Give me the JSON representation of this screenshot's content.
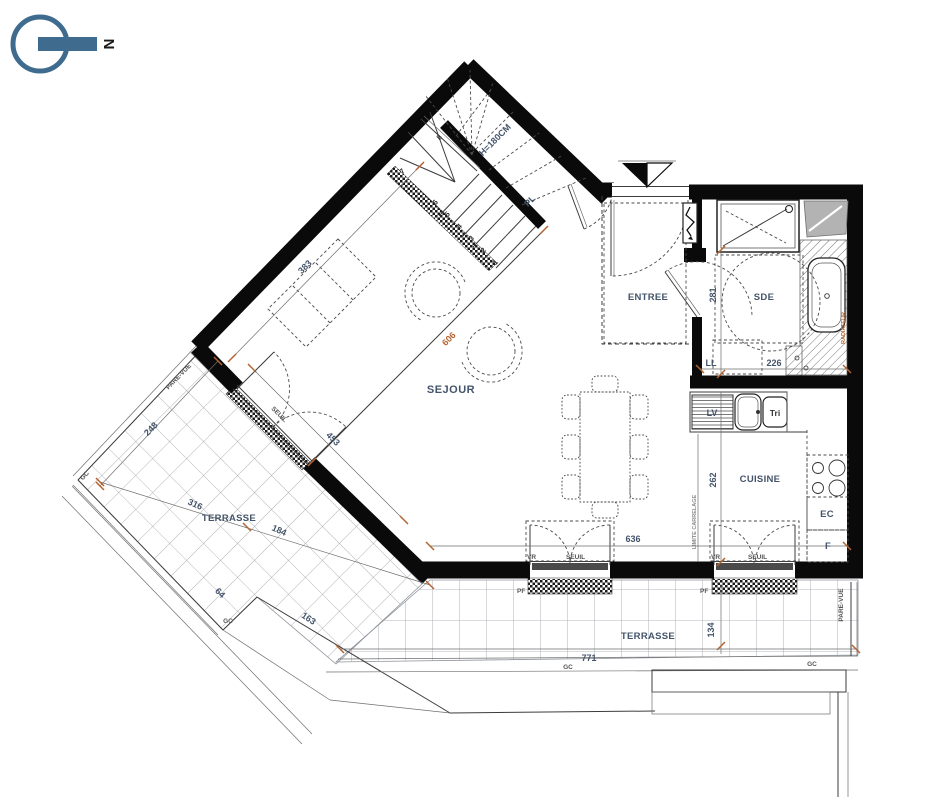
{
  "north": {
    "letter": "N"
  },
  "rooms": {
    "sejour": "SEJOUR",
    "entree": "ENTREE",
    "sde": "SDE",
    "cuisine": "CUISINE",
    "terrasse_left": "TERRASSE",
    "terrasse_bottom": "TERRASSE"
  },
  "labels": {
    "pare_vue_left": "PARE-VUE",
    "pare_vue_right": "PARE-VUE",
    "gc_west": "GC",
    "gc_notch": "GC",
    "gc_south1": "GC",
    "gc_south2": "GC",
    "ll": "LL",
    "lv": "LV",
    "tri": "Tri",
    "ec": "EC",
    "f": "F",
    "pl": "PL",
    "vr_left": "VR",
    "vr_right": "VR",
    "seuil_left": "SEUIL",
    "seuil_right": "SEUIL",
    "seuil_bay": "SEUIL",
    "pf_left": "PF",
    "pf_right": "PF",
    "limite_carrelage": "LIMITE CARRELAGE",
    "radiateur": "RADIATEUR",
    "stair_height": "H=180CM"
  },
  "dimensions": {
    "sofa_wall": "383",
    "sejour_diag": "606",
    "bay_wall": "453",
    "inner_width": "636",
    "sde_depth": "281",
    "sde_width": "226",
    "kitchen_depth": "262",
    "terrace_s_width": "771",
    "terrace_s_depth": "134",
    "terrace_w_a": "248",
    "terrace_w_b": "316",
    "terrace_w_c": "184",
    "terrace_w_d": "64",
    "terrace_w_e": "163"
  },
  "stair_steps": [
    "1",
    "2",
    "3",
    "4",
    "5",
    "6",
    "7",
    "8"
  ],
  "colors": {
    "accent_orange": "#b5622f",
    "label_blue": "#44546a",
    "north_blue": "#3f6c8e",
    "wall_black": "#0a0a0a"
  }
}
